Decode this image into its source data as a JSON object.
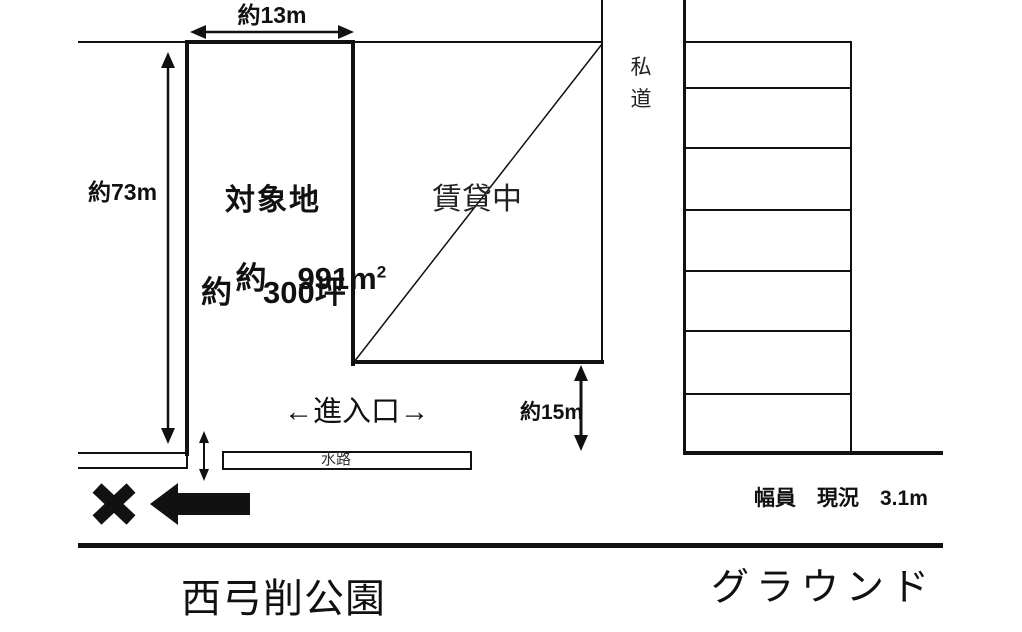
{
  "diagram": {
    "dimensions": {
      "top_width": "約13m",
      "left_height": "約73m",
      "right_height": "約15m"
    },
    "plot": {
      "name": "対象地",
      "area_text": "約　991m",
      "area_sup": "2",
      "tsubo_text": "約　300坪"
    },
    "rented_label": "賃貸中",
    "private_road_label": [
      "私",
      "道"
    ],
    "entrance_label": "←進入口→",
    "waterway_label": "水路",
    "road_width_label": "幅員　現況　3.1m",
    "park_label": "西弓削公園",
    "ground_label": "グラウンド",
    "colors": {
      "ink": "#111111",
      "background": "#ffffff"
    }
  }
}
